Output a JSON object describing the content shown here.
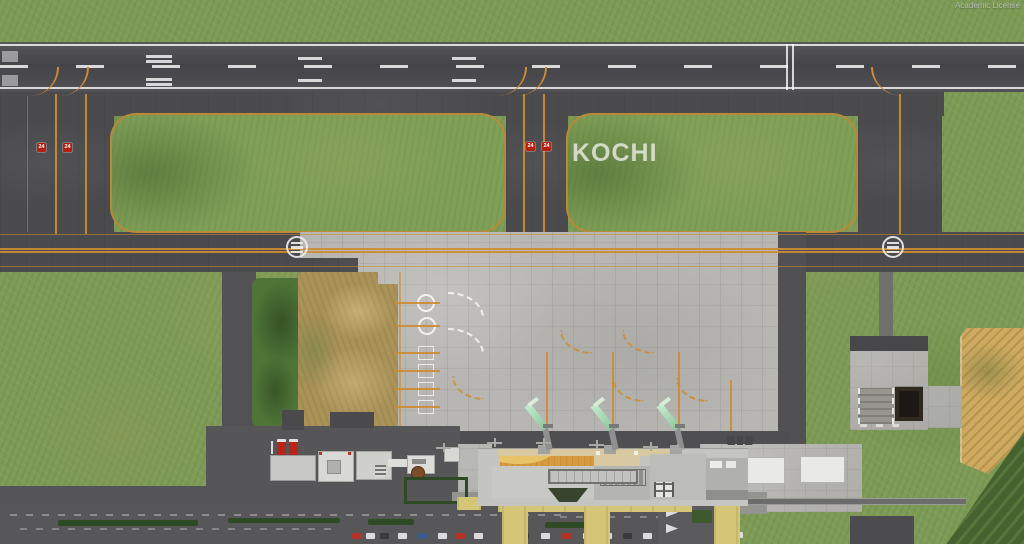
{
  "scene": {
    "watermark": "Academic License",
    "ground_label": "KOCHI",
    "runway_sign": "24",
    "colors": {
      "grass": "#7d9b56",
      "runway_asphalt": "#4a494d",
      "taxiway_asphalt": "#4b4b4e",
      "apron_concrete": "#b7b6b2",
      "taxiway_line_orange": "#cd8c33",
      "runway_sign_red": "#b51f10",
      "jet_bridge_green": "#9fd4a8",
      "terminal_roof_orange": "#d79b3e",
      "canopy_yellow": "#d4c676",
      "farm_field_tan": "#cdaa60",
      "hedge_green": "#2e4a24"
    }
  }
}
